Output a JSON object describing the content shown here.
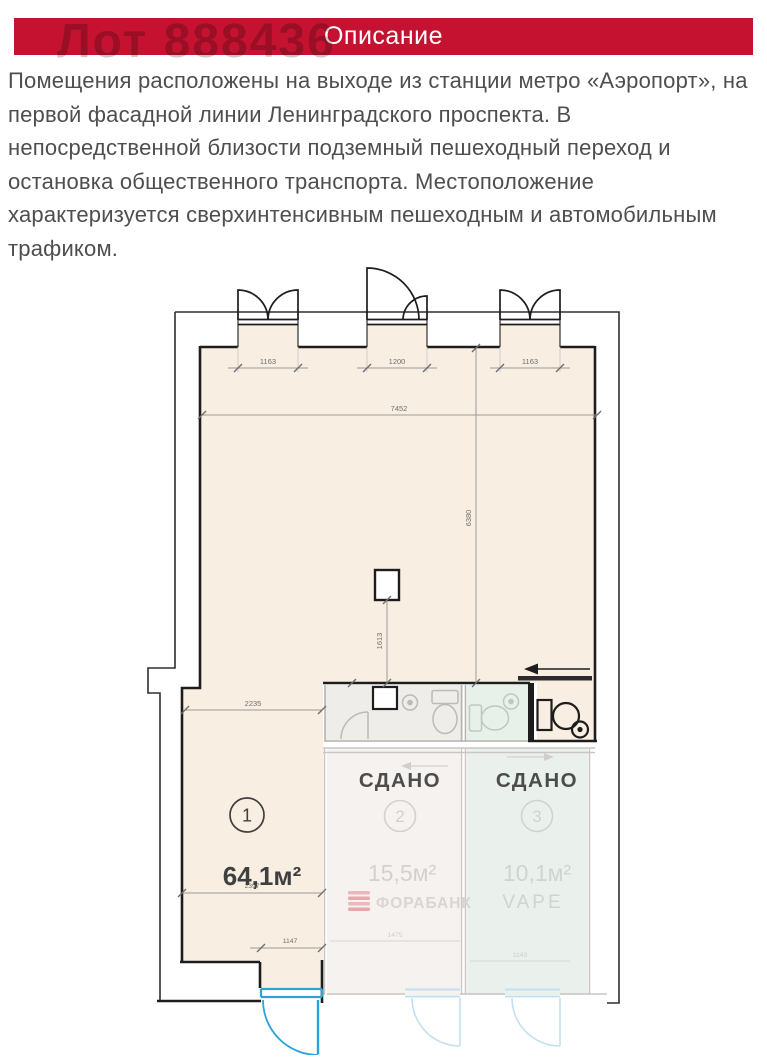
{
  "header": {
    "title": "Описание",
    "bar_color": "#c51230"
  },
  "lot": {
    "number": "Лот 888436"
  },
  "description": "Помещения расположены на выходе из станции метро «Аэропорт», на первой фасадной линии Ленинградского проспекта. В непосредственной близости подземный пешеходный переход и остановка общественного транспорта. Местоположение характеризуется сверхинтенсивным пешеходным и автомобильным трафиком.",
  "floorplan": {
    "dims": {
      "bay1": "1163",
      "bay2": "1200",
      "bay3": "1163",
      "total_width": "7452",
      "depth": "6380",
      "column_offset": "1613",
      "left_width": "2235",
      "unit1_width": "2397",
      "entry_door": "1147",
      "unit2_width": "1475",
      "unit3_width": "1143"
    },
    "units": {
      "u1": {
        "number": "1",
        "area": "64,1м²"
      },
      "u2": {
        "number": "2",
        "status": "СДАНО",
        "area": "15,5м²",
        "tenant": "ФОРАБАНК"
      },
      "u3": {
        "number": "3",
        "status": "СДАНО",
        "area": "10,1м²",
        "tenant": "VAPE"
      }
    },
    "colors": {
      "active_fill": "#f8efe2",
      "door_blue": "#2aa3d9"
    }
  }
}
